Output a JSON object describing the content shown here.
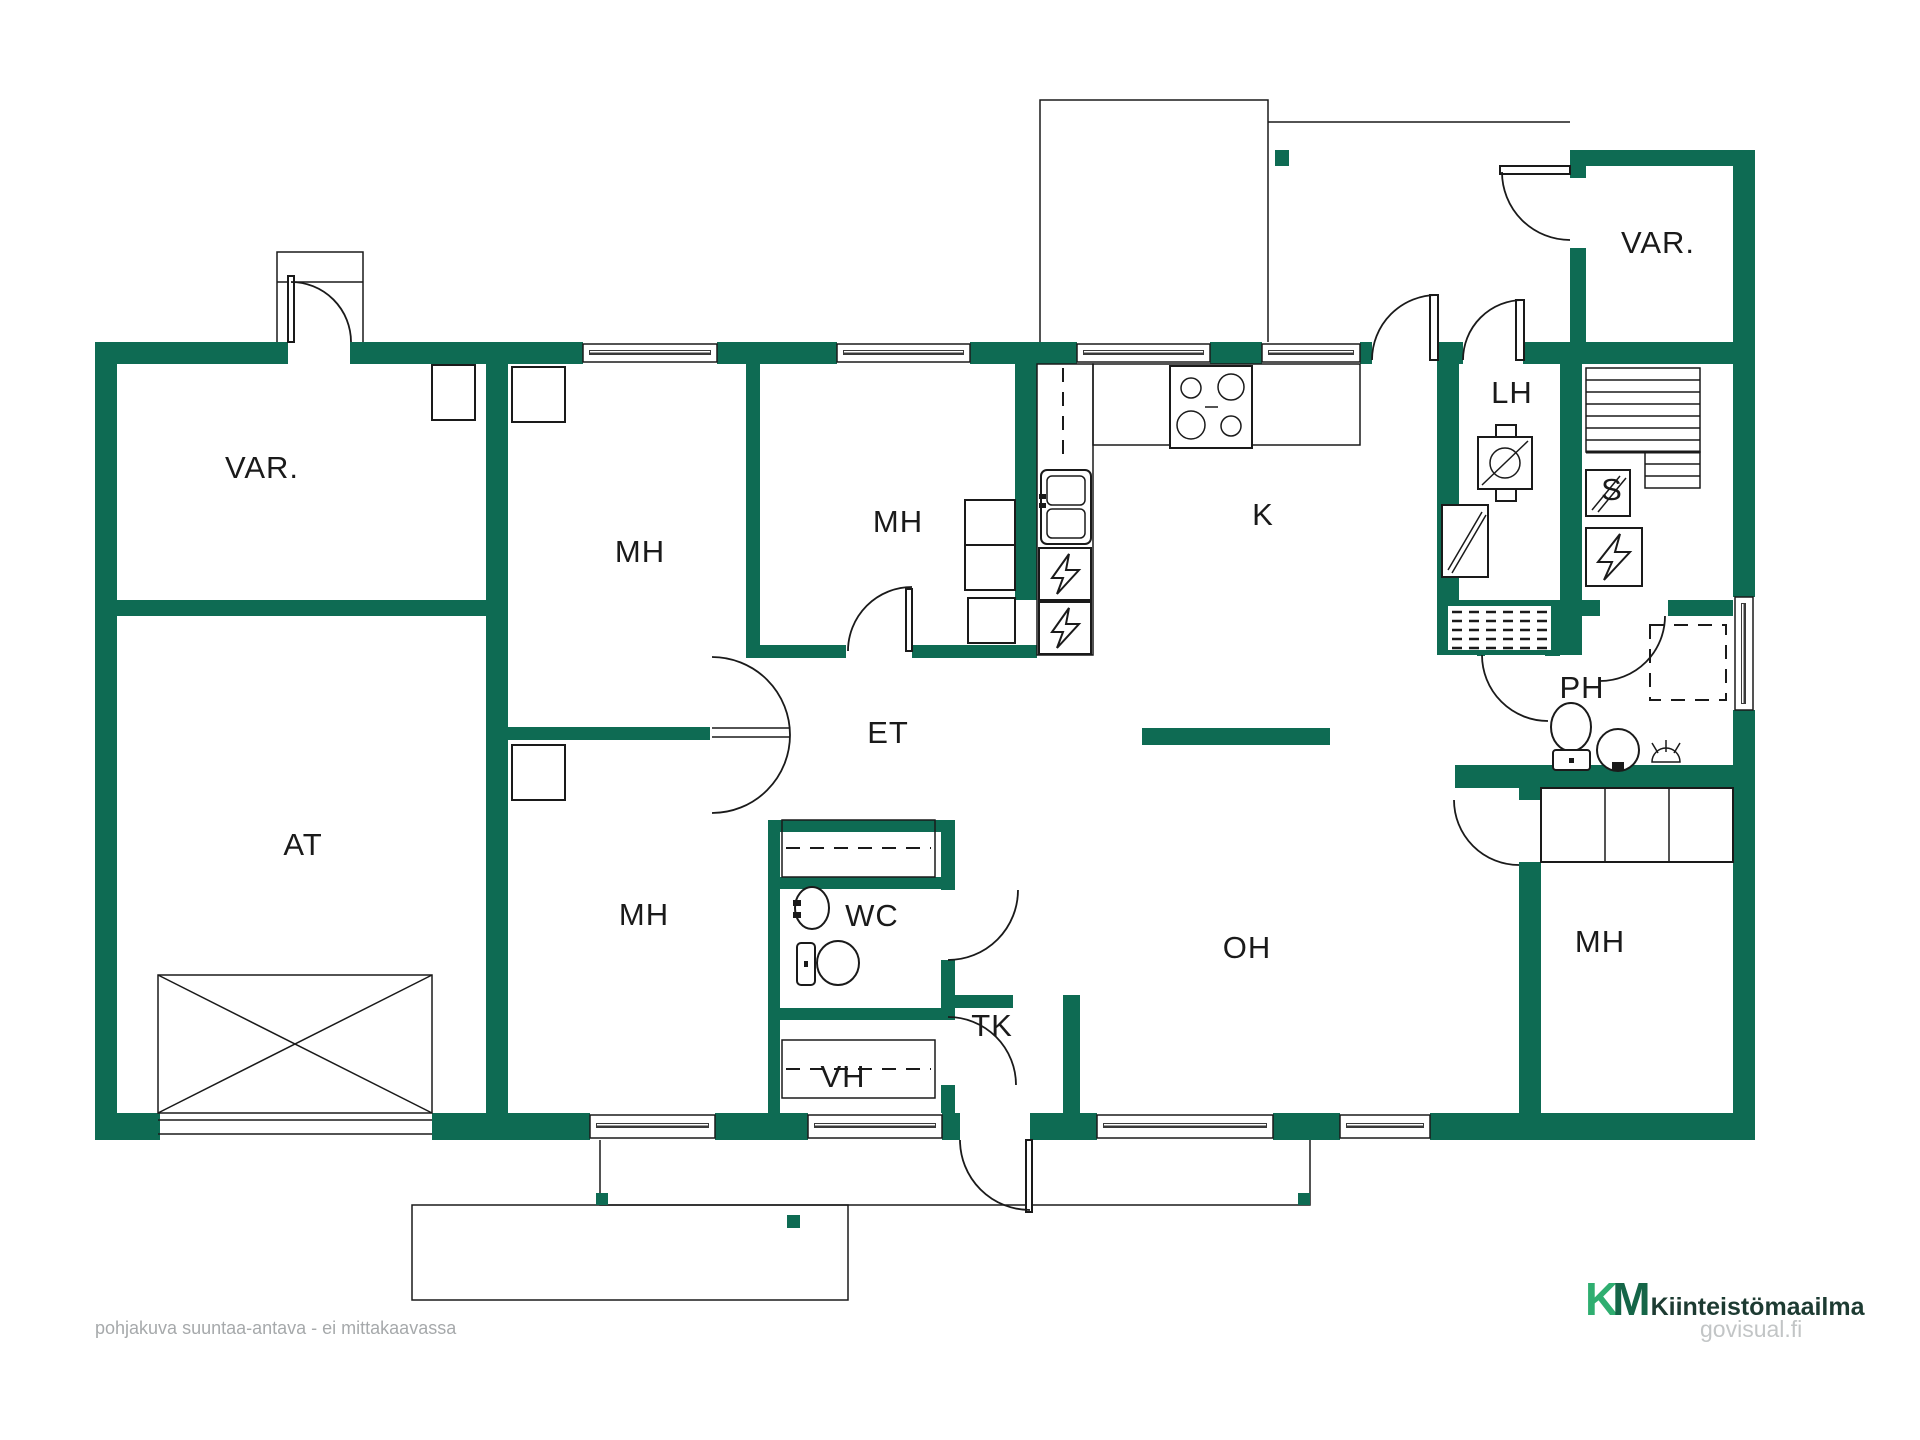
{
  "colors": {
    "wall": "#0E6B53",
    "line": "#1a1a1a",
    "label": "#1a1a1a",
    "footer_gray": "#a6a9ab",
    "logo_green_dark": "#156648",
    "logo_green_light": "#35B878",
    "logo_text": "#1d3b32",
    "govisual_gray": "#c2c5c6"
  },
  "rooms": [
    {
      "id": "var-left",
      "label": "VAR.",
      "x": 262,
      "y": 468
    },
    {
      "id": "at",
      "label": "AT",
      "x": 303,
      "y": 845
    },
    {
      "id": "mh-top-left",
      "label": "MH",
      "x": 640,
      "y": 552
    },
    {
      "id": "mh-top-center",
      "label": "MH",
      "x": 898,
      "y": 522
    },
    {
      "id": "k",
      "label": "K",
      "x": 1263,
      "y": 515
    },
    {
      "id": "lh",
      "label": "LH",
      "x": 1512,
      "y": 393
    },
    {
      "id": "var-right",
      "label": "VAR.",
      "x": 1658,
      "y": 243
    },
    {
      "id": "s",
      "label": "S",
      "x": 1612,
      "y": 490
    },
    {
      "id": "ph",
      "label": "PH",
      "x": 1582,
      "y": 688
    },
    {
      "id": "et",
      "label": "ET",
      "x": 888,
      "y": 733
    },
    {
      "id": "wc",
      "label": "WC",
      "x": 872,
      "y": 916
    },
    {
      "id": "mh-bottom-left",
      "label": "MH",
      "x": 644,
      "y": 915
    },
    {
      "id": "oh",
      "label": "OH",
      "x": 1247,
      "y": 948
    },
    {
      "id": "mh-right",
      "label": "MH",
      "x": 1600,
      "y": 942
    },
    {
      "id": "tk",
      "label": "TK",
      "x": 992,
      "y": 1026
    },
    {
      "id": "vh",
      "label": "VH",
      "x": 843,
      "y": 1077
    }
  ],
  "footer": {
    "disclaimer": "pohjakuva suuntaa-antava - ei mittakaavassa"
  },
  "logo": {
    "k": "K",
    "m": "M",
    "name": "Kiinteistömaailma",
    "site": "govisual.fi"
  },
  "icons": {
    "stove-icon": "cooktop square with 4 burner circles",
    "kitchen-sink-icon": "double-basin sink",
    "fridge-icon": "square with lightning bolt (electric appliance)",
    "freezer-icon": "square with lightning bolt (electric appliance)",
    "boiler-icon": "square with circle and diagonal slash",
    "sauna-stove-icon": "square with lightning bolt (kiuas)",
    "sauna-benches-icon": "parallel bench lines",
    "glass-panel-icon": "square with diagonal glazing lines",
    "drying-rack-icon": "dashed grid block",
    "toilet-icon": "toilet bowl with tank",
    "washbasin-icon": "round basin",
    "shower-icon": "floor drain with spray",
    "wardrobe-icon": "rectangular closet boxes",
    "garage-door-icon": "rectangle with X cross",
    "window-icon": "double line in wall opening",
    "door-arc-icon": "quarter-circle door swing"
  }
}
